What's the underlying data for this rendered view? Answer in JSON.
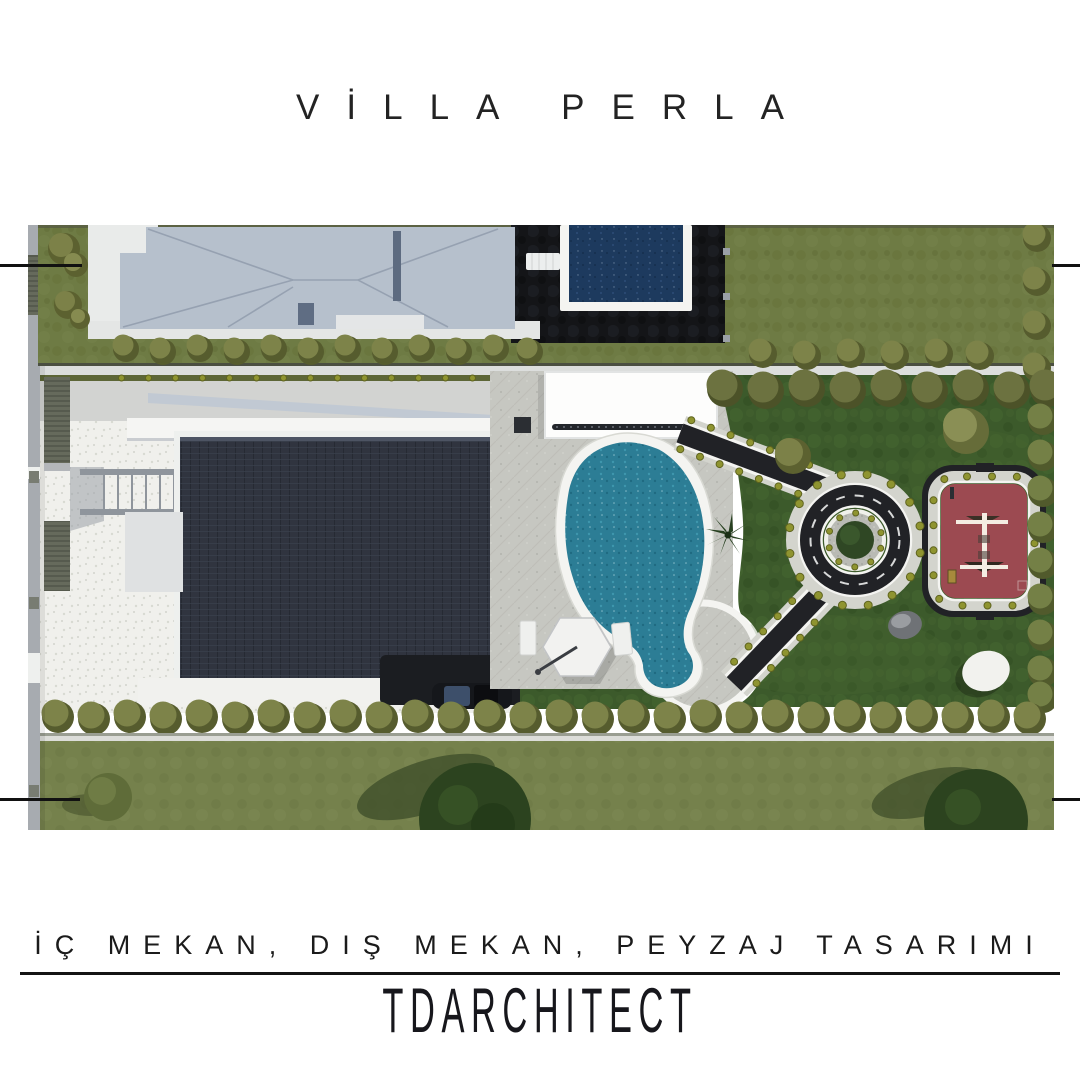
{
  "page": {
    "title": "VİLLA PERLA",
    "tagline": "İÇ MEKAN, DIŞ MEKAN, PEYZAJ TASARIMI",
    "brand": "TDARCHITECT"
  },
  "palette": {
    "paper": "#ffffff",
    "ink": "#232323",
    "olive_field": "#6e7b44",
    "olive_field_bottom": "#75814c",
    "lawn_dark": "#3c5a2b",
    "lawn_light": "#4a6a33",
    "neighbor_roof": "#b6c0cc",
    "roof_ridge": "#96a1b1",
    "patio_black": "#141518",
    "pool_navy": "#1d3a5e",
    "pool_teal": "#2c7d95",
    "coping_white": "#f4f4f1",
    "terrace_white": "#f0f0ec",
    "stone_paving": "#c6c7c1",
    "villa_roof": "#30343f",
    "asphalt_dark": "#212226",
    "path_border": "#d3d4cd",
    "plant_dot": "#8f9430",
    "playground_red": "#9c4a51",
    "wall_gray": "#a7abb0",
    "hedge_olive": "#7d8349",
    "hedge_dark": "#565c2e",
    "tree_dark": "#2c431f",
    "car_body": "#15171b",
    "car_glass": "#3d4f6a",
    "gravel_gray": "#b9bab4",
    "road_gray": "#d2d3d1"
  }
}
